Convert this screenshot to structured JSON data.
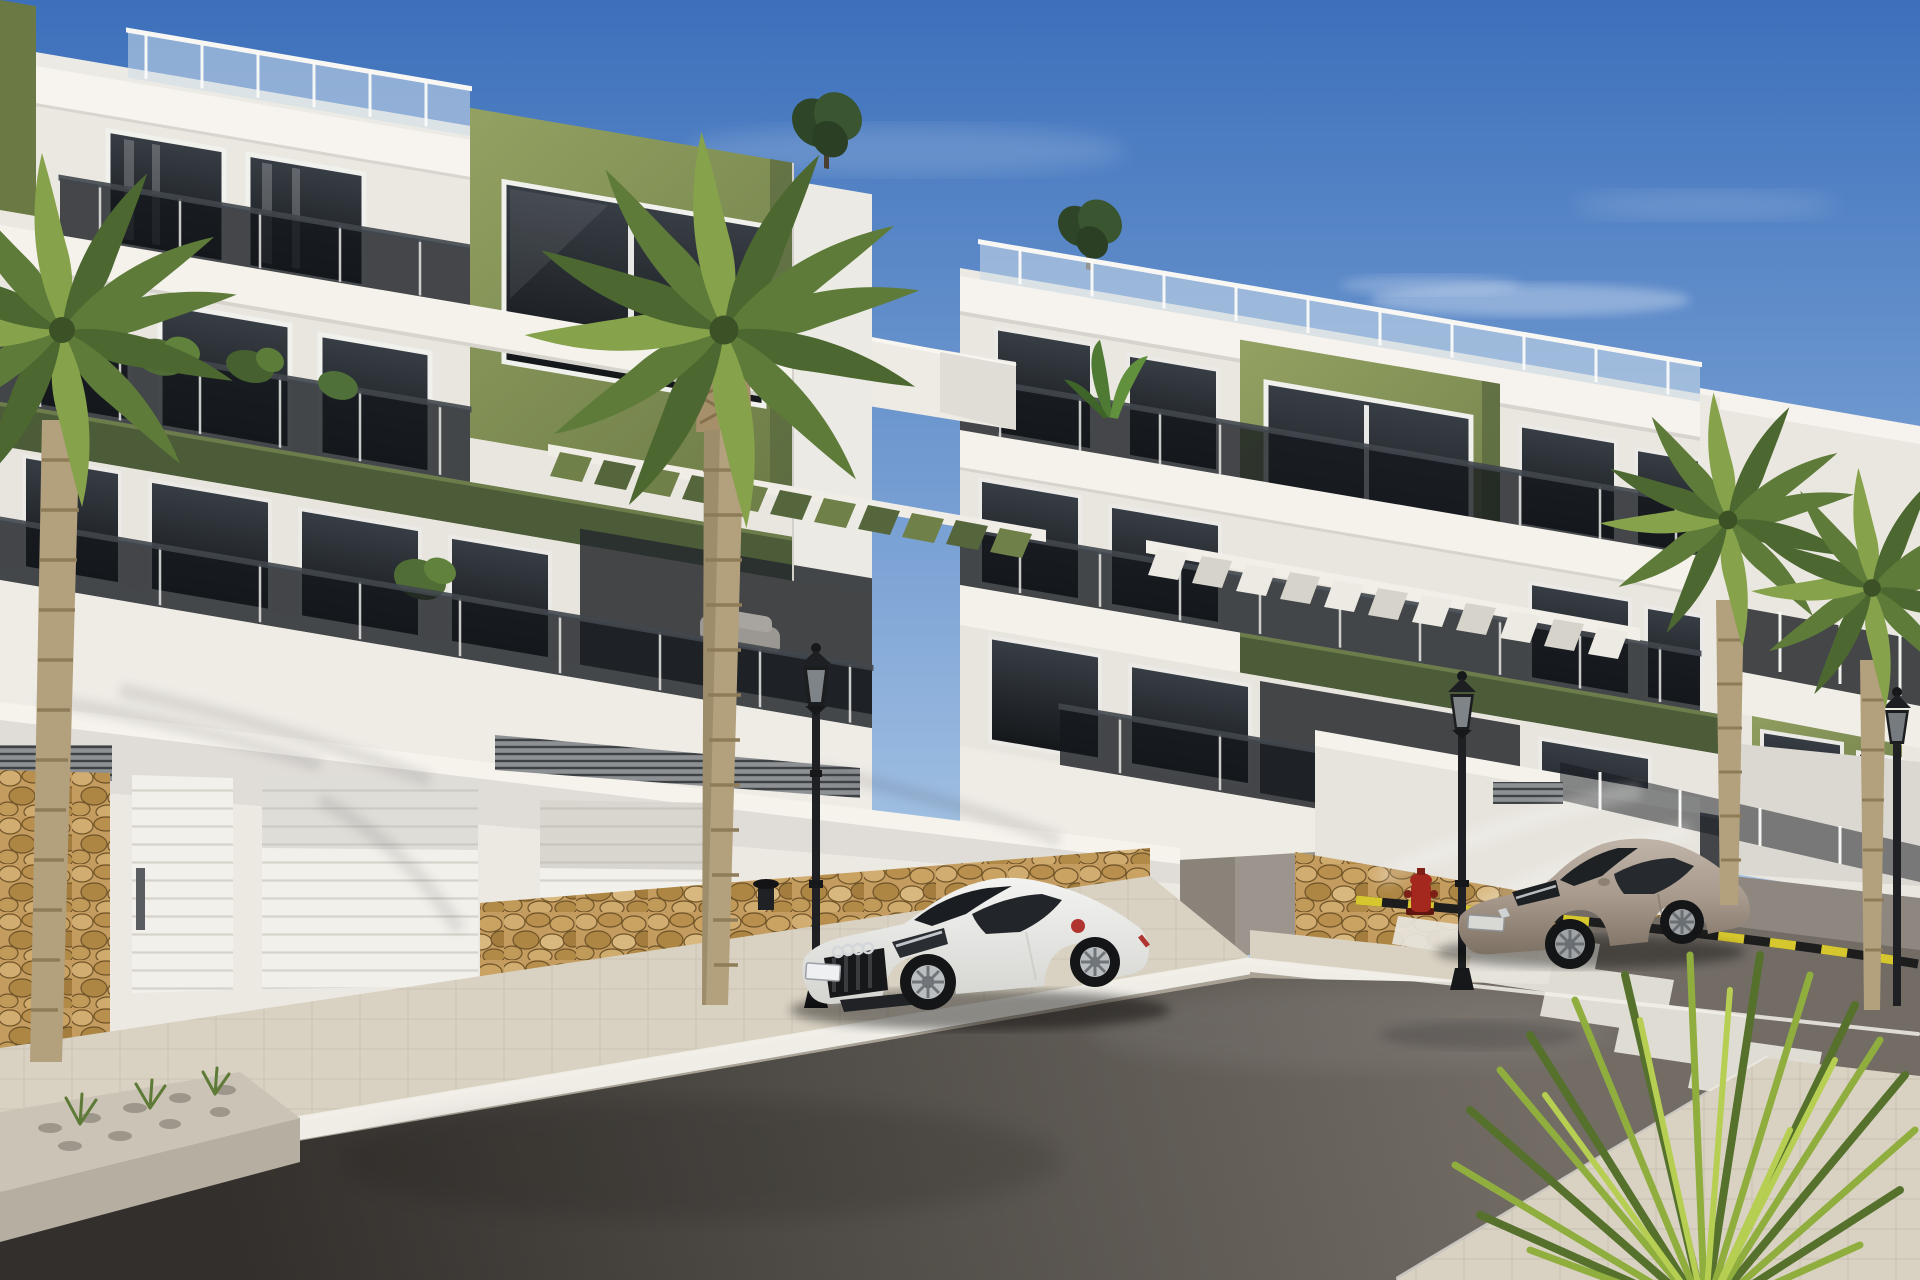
{
  "scene": {
    "type": "architectural-photorealistic-render",
    "description": "Sunny exterior render of a modern white and olive-green three-storey apartment complex with smoked-glass balconies, pergolas, street-level garages on a clean street with palm trees, two parked cars, classic lamp posts, a fire hydrant, a zebra crosswalk and a yellow-black road edge marking.",
    "time_of_day": "midday-sun",
    "visible_text": "none",
    "objects": [
      "apartment-building-left",
      "apartment-building-center",
      "apartment-building-right",
      "rooftop-glass-railings",
      "smoked-glass-balconies",
      "green-pergola",
      "white-pergola",
      "garage-doors",
      "pedestrian-door",
      "ventilation-grilles",
      "stone-clad-wall-bases",
      "white-coupe-car",
      "gray-coupe-car",
      "street-lamp-1",
      "street-lamp-2",
      "street-lamp-3",
      "fire-hydrant",
      "bollard",
      "palm-tree-left",
      "palm-tree-center",
      "palm-tree-right-1",
      "palm-tree-right-2",
      "fan-palm-bush",
      "rooftop-trees",
      "balcony-plants",
      "planter-bed",
      "sidewalk",
      "curb",
      "road",
      "crosswalk",
      "hazard-road-marking",
      "clouds"
    ]
  },
  "counts": {
    "buildings": 3,
    "building_floors": 3,
    "cars": 2,
    "street_lamps": 3,
    "palm_trees": 5,
    "garage_doors": 2,
    "crosswalk_stripes": 6
  },
  "colors": {
    "sky_top": "#3c70bb",
    "sky_mid": "#7fa5d6",
    "sky_horizon": "#dcebf6",
    "facade_white": "#f5f2ec",
    "facade_shaded": "#e6e3dd",
    "accent_olive_light": "#93a162",
    "accent_olive": "#6d7c47",
    "accent_olive_dark": "#4d5c38",
    "glass_window": "#1d2125",
    "glass_balustrade": "#14181d",
    "stone_tan": "#c49c5f",
    "sidewalk": "#d9d2c3",
    "curb_white": "#efede6",
    "road_light": "#726c65",
    "road_dark": "#332f2c",
    "marking_white": "#e8e5dd",
    "hazard_yellow": "#d6c72e",
    "car_white": "#f3f3f1",
    "car_gray": "#a89a8d",
    "palm_green": "#5e7b39",
    "palm_green_dark": "#46602d",
    "palm_green_light": "#8aa74b",
    "trunk_brown": "#b3a07d",
    "hydrant_red": "#a5281e",
    "lamp_black": "#1e2023"
  }
}
